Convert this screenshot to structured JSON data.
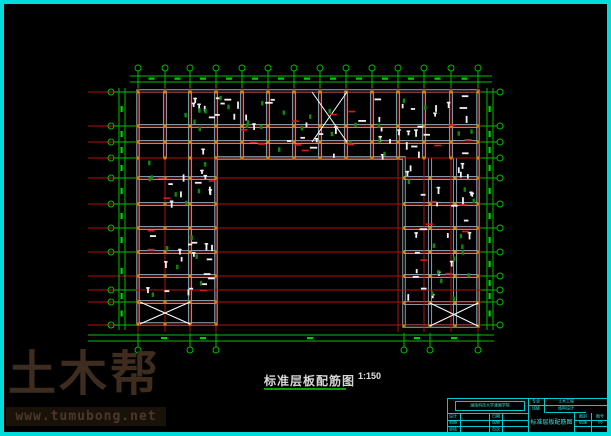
{
  "caption": {
    "text": "标准层板配筋图",
    "scale": "1:150"
  },
  "watermark": {
    "brand": "土木帮",
    "url": "www.tumubong.net"
  },
  "title_block": {
    "school": "湖南科技大学潇湘学院",
    "rowA": [
      {
        "label": "专业",
        "value": "土木工程"
      },
      {
        "label": "班级",
        "value": "结构设计"
      }
    ],
    "left_rows": [
      [
        "设计",
        "",
        "日期",
        ""
      ],
      [
        "制图",
        "",
        "成绩",
        ""
      ],
      [
        "审核",
        "",
        "页次",
        ""
      ]
    ],
    "drawing_name": "标准层板配筋图",
    "right": {
      "h1": "图别",
      "h2": "图号",
      "v1": "结施",
      "v2": "05"
    }
  },
  "colors": {
    "background": "#000000",
    "frame": "#00dcdc",
    "grid_red": "#b31212",
    "mark_red": "#d81a1a",
    "dim_green": "#00bb00",
    "dim_mark": "#00d000",
    "beam": "#8fb0bc",
    "mark_white": "#f2f2f2",
    "mark_green": "#0c8a0c",
    "column_dot": "#c98c00",
    "brace_white": "#ffffff"
  },
  "drawing": {
    "axes_x": [
      138,
      165,
      190,
      216,
      242,
      268,
      294,
      320,
      346,
      372,
      398,
      424,
      451,
      478
    ],
    "axes_y": [
      92,
      126,
      142,
      158,
      178,
      204,
      228,
      252,
      276,
      290,
      302,
      325
    ],
    "wing_axis_limits": {
      "left_max_x": 216,
      "right_min_x": 398
    },
    "grid_h_x1": 88,
    "grid_h_x2": 494,
    "grid_v_y1": 86,
    "grid_v_y2_short": 160,
    "grid_v_y2_long": 332,
    "outline_path": "M138,91 L478,91 L478,326 L404,326 L404,158 L216,158 L216,324 L138,324 Z",
    "beams_h": [
      [
        138,
        478,
        126
      ],
      [
        138,
        478,
        142
      ],
      [
        138,
        216,
        178
      ],
      [
        138,
        216,
        204
      ],
      [
        138,
        216,
        228
      ],
      [
        138,
        216,
        252
      ],
      [
        138,
        216,
        276
      ],
      [
        138,
        216,
        302
      ],
      [
        404,
        478,
        178
      ],
      [
        404,
        478,
        204
      ],
      [
        404,
        478,
        228
      ],
      [
        404,
        478,
        252
      ],
      [
        404,
        478,
        276
      ],
      [
        404,
        478,
        303
      ]
    ],
    "beams_v_topwing": {
      "xs": [
        165,
        190,
        216,
        242,
        268,
        294,
        320,
        346,
        372,
        398,
        424,
        451
      ],
      "y1": 91,
      "y2": 158
    },
    "beams_v_wings": [
      [
        190,
        158,
        324
      ],
      [
        430,
        158,
        326
      ],
      [
        455,
        158,
        326
      ]
    ],
    "x_braces": [
      [
        312,
        92,
        347,
        142
      ],
      [
        140,
        302,
        190,
        324
      ],
      [
        430,
        303,
        478,
        326
      ]
    ],
    "dims": {
      "top": {
        "bubble_y": 68,
        "lines_y": [
          76,
          82
        ],
        "line_x1": 130,
        "line_x2": 492,
        "tick_y2": 88
      },
      "bottom": {
        "bubble_y": 350,
        "lines_y": [
          335,
          341
        ],
        "line_x1": 88,
        "line_x2": 494,
        "tick_y2": 333,
        "bubble_xs": [
          138,
          190,
          216,
          404,
          430,
          478
        ]
      },
      "left": {
        "bubble_x": 111,
        "lines_x": [
          119,
          125
        ],
        "line_y1": 88,
        "line_y2": 330,
        "tick_x2": 136,
        "bubble_ys": [
          92,
          126,
          142,
          158,
          178,
          204,
          228,
          252,
          290,
          302,
          325
        ]
      },
      "right": {
        "bubble_x": 500,
        "lines_x": [
          487,
          493
        ],
        "line_y1": 88,
        "line_y2": 330,
        "tick_x2": 481,
        "bubble_ys": [
          92,
          126,
          142,
          158,
          178,
          204,
          228,
          252,
          276,
          290,
          302,
          325
        ]
      }
    },
    "dot_grids": [
      {
        "xs": [
          138,
          165,
          190,
          216,
          242,
          268,
          294,
          320,
          346,
          372,
          398,
          424,
          451,
          478
        ],
        "ys": [
          92,
          126,
          142,
          158
        ]
      },
      {
        "xs": [
          138,
          165,
          190,
          216
        ],
        "ys": [
          178,
          204,
          228,
          252,
          276,
          302,
          324
        ]
      },
      {
        "xs": [
          404,
          430,
          455,
          478
        ],
        "ys": [
          178,
          204,
          228,
          252,
          276,
          303,
          326
        ]
      }
    ],
    "scatter_seed": 20240715,
    "scatter_regions": [
      {
        "x": 168,
        "y": 94,
        "w": 308,
        "h": 60,
        "white": 48,
        "green": 26,
        "red": 12
      },
      {
        "x": 140,
        "y": 160,
        "w": 72,
        "h": 140,
        "white": 26,
        "green": 13,
        "red": 6
      },
      {
        "x": 406,
        "y": 160,
        "w": 68,
        "h": 140,
        "white": 26,
        "green": 13,
        "red": 6
      }
    ]
  }
}
